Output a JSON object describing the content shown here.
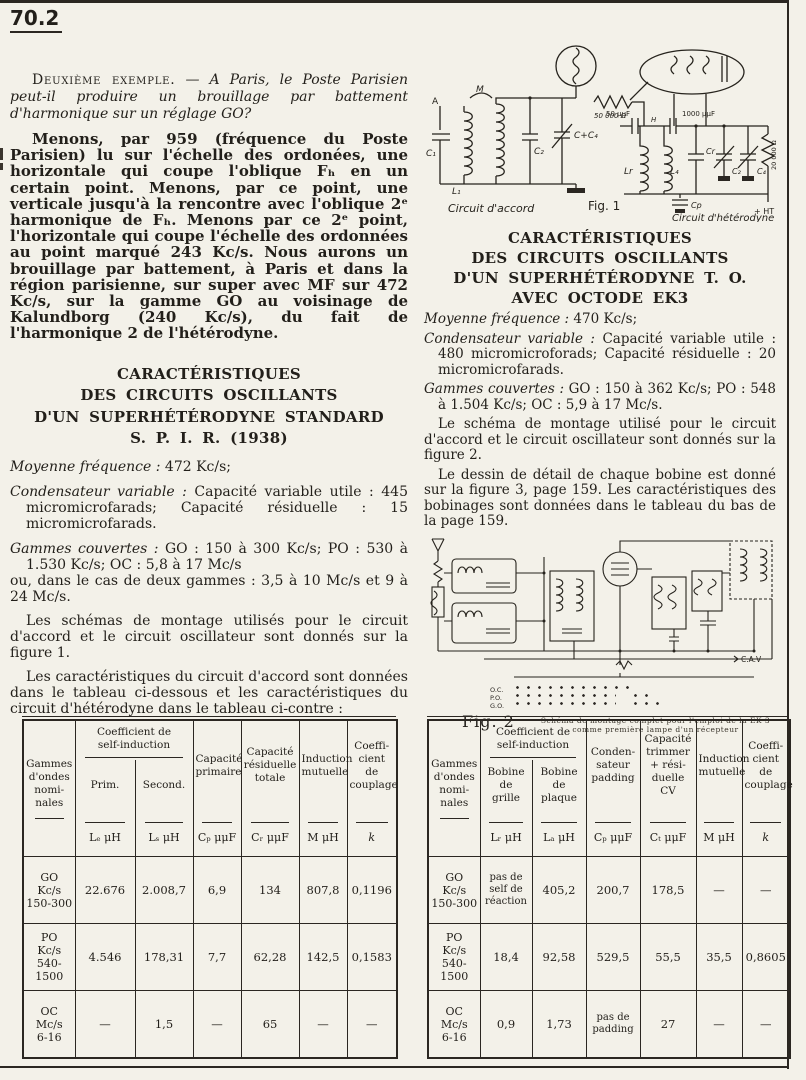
{
  "page": {
    "number": "70.2"
  },
  "left": {
    "intro_lead": "Deuxième exemple.",
    "intro_dash": " — ",
    "intro_italic": "A Paris, le Poste Parisien peut-il produire un brouillage par battement d'harmonique sur un réglage GO?",
    "para_menons": "Menons, par 959 (fréquence du Poste Parisien) lu sur l'échelle des ordonées, une horizontale qui coupe l'oblique Fₕ en un certain point. Menons, par ce point, une verticale jusqu'à la rencontre avec l'oblique 2ᵉ harmonique de Fₕ. Menons par ce 2ᵉ point, l'horizontale qui coupe l'échelle des ordonnées au point marqué 243 Kc/s. Nous aurons un brouillage par battement, à Paris et dans la région parisienne, sur super avec MF sur 472 Kc/s, sur la gamme GO au voisinage de Kalundborg (240 Kc/s), du fait de l'harmonique 2 de l'hétérodyne.",
    "heading_l1": "CARACTÉRISTIQUES",
    "heading_l2": "DES CIRCUITS OSCILLANTS",
    "heading_l3": "D'UN SUPERHÉTÉRODYNE STANDARD",
    "heading_l4": "S. P. I. R. (1938)",
    "spec_mf_lead": "Moyenne fréquence :",
    "spec_mf_rest": " 472 Kc/s;",
    "spec_cv_lead": "Condensateur variable :",
    "spec_cv_rest": " Capacité variable utile : 445 micromicrofarads; Capacité résiduelle : 15 micromicrofarads.",
    "spec_g_lead": "Gammes couvertes :",
    "spec_g_rest": " GO : 150 à 300 Kc/s; PO : 530 à 1.530 Kc/s; OC : 5,8 à 17 Mc/s",
    "spec_g2": "ou, dans le cas de deux gammes : 3,5 à 10 Mc/s et 9 à 24 Mc/s.",
    "para_schemas": "Les schémas de montage utilisés pour le circuit d'accord et le circuit oscillateur sont donnés sur la figure 1.",
    "para_tableaux": "Les caractéristiques du circuit d'accord sont données dans le tableau ci-dessous et les caractéristiques du circuit d'hétérodyne dans le tableau ci-contre :"
  },
  "right": {
    "heading_l1": "CARACTÉRISTIQUES",
    "heading_l2": "DES CIRCUITS OSCILLANTS",
    "heading_l3": "D'UN SUPERHÉTÉRODYNE T. O.",
    "heading_l4": "AVEC OCTODE EK3",
    "spec_mf_lead": "Moyenne fréquence :",
    "spec_mf_rest": " 470 Kc/s;",
    "spec_cv_lead": "Condensateur variable :",
    "spec_cv_rest": " Capacité variable utile : 480 micromicroforads; Capacité résiduelle : 20 micromicrofarads.",
    "spec_g_lead": "Gammes couvertes :",
    "spec_g_rest": " GO : 150 à 362 Kc/s; PO : 548 à 1.504 Kc/s; OC : 5,9 à 17 Mc/s.",
    "para_schema": "Le schéma de montage utilisé pour le circuit d'accord et le circuit oscillateur sont donnés sur la figure 2.",
    "para_dessin": "Le dessin de détail de chaque bobine est donné sur la figure 3, page 159. Les caractéristiques des bobinages sont données dans le tableau du bas de la page 159."
  },
  "fig1": {
    "caption": "Fig. 1",
    "label_accord": "Circuit d'accord",
    "label_heterodyne": "Circuit d'hétérodyne",
    "ann": {
      "a": "A",
      "m": "M",
      "c1": "C₁",
      "l1": "L₁",
      "c2": "C₂",
      "cc4": "C+C₄",
      "r50k": "50 000 Ω",
      "c50": "50 μμF",
      "h": "H",
      "c1000": "1000 μμF",
      "lr": "Lr",
      "l4": "L₄",
      "cr": "Cr",
      "ct": "C₂",
      "c4": "C₄",
      "r20k": "20 000 Ω",
      "cp": "Cp",
      "ht": "+ HT"
    }
  },
  "fig2": {
    "caption": "Fig. 2",
    "caption_note1": "Schéma de montage complet pour l'emploi de la EK 3",
    "caption_note2": "comme première lampe d'un récepteur",
    "cav": "C.A.V",
    "legend": [
      "O.C.",
      "P.O.",
      "G.O."
    ]
  },
  "left_table": {
    "col_gammes": "Gammes\nd'ondes\nnomi-\nnales",
    "group_self": "Coefficient de\nself-induction",
    "sub_prim": "Prim.",
    "sub_second": "Second.",
    "col_cap_prim": "Capacité\nprimaire",
    "col_cap_res": "Capacité\nrésiduelle\ntotale",
    "col_induction": "Induction\nmutuelle",
    "col_couplage": "Coeffi-\ncient\nde\ncouplage",
    "units": [
      "Lₑ μH",
      "Lₛ μH",
      "Cₚ μμF",
      "Cᵣ μμF",
      "M μH",
      "k"
    ],
    "rows": [
      {
        "label": "GO\nKc/s\n150-300",
        "v": [
          "22.676",
          "2.008,7",
          "6,9",
          "134",
          "807,8",
          "0,1196"
        ]
      },
      {
        "label": "PO\nKc/s\n540-1500",
        "v": [
          "4.546",
          "178,31",
          "7,7",
          "62,28",
          "142,5",
          "0,1583"
        ]
      },
      {
        "label": "OC\nMc/s\n6-16",
        "v": [
          "—",
          "1,5",
          "—",
          "65",
          "—",
          "—"
        ]
      }
    ]
  },
  "right_table": {
    "col_gammes": "Gammes\nd'ondes\nnomi-\nnales",
    "group_self": "Coefficient de\nself-induction",
    "sub_grille": "Bobine\nde\ngrille",
    "sub_plaque": "Bobine\nde\nplaque",
    "col_padding": "Conden-\nsateur\npadding",
    "col_trimmer": "Capacité\ntrimmer\n+ rési-\nduelle\nCV",
    "col_induction": "Induction\nmutuelle",
    "col_couplage": "Coeffi-\ncient\nde\ncouplage",
    "units": [
      "Lᵣ μH",
      "Lₐ μH",
      "Cₚ μμF",
      "Cₜ μμF",
      "M μH",
      "k"
    ],
    "rows": [
      {
        "label": "GO\nKc/s\n150-300",
        "v": [
          "pas de\nself de\nréaction",
          "405,2",
          "200,7",
          "178,5",
          "—",
          "—"
        ]
      },
      {
        "label": "PO\nKc/s\n540-1500",
        "v": [
          "18,4",
          "92,58",
          "529,5",
          "55,5",
          "35,5",
          "0,8605"
        ]
      },
      {
        "label": "OC\nMc/s\n6-16",
        "v": [
          "0,9",
          "1,73",
          "pas de\npadding",
          "27",
          "—",
          "—"
        ]
      }
    ]
  }
}
